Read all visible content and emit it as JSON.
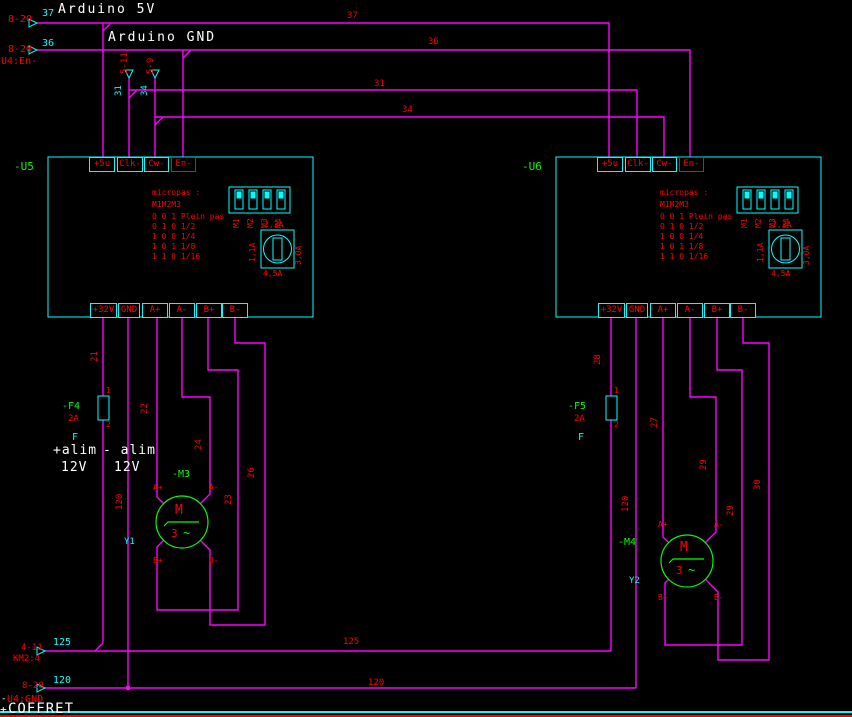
{
  "titles": {
    "arduino_5v": "Arduino 5V",
    "arduino_gnd": "Arduino GND"
  },
  "sources": {
    "s37_ref": "8-20",
    "s37_num": "37",
    "s36_ref": "8-20",
    "s36_dest": "U4:En-",
    "s36_num": "36",
    "x31_ref": "5-11",
    "x31_num": "31",
    "x34_ref": "5-9",
    "x34_num": "34"
  },
  "wire_labels": {
    "w37": "37",
    "w36": "36",
    "w31": "31",
    "w34": "34"
  },
  "drivers": {
    "u5_ref": "-U5",
    "u6_ref": "-U6",
    "top_terms": [
      "+5u",
      "Clk-",
      "Cw-",
      "En-"
    ],
    "bot_terms": [
      "+32V",
      "GND",
      "A+",
      "A-",
      "B+",
      "B-"
    ],
    "micro_title": "micropas :",
    "micro_head": "M1M2M3",
    "micro_rows": [
      "0 0 1 Plein pas",
      "0 1 0 1/2",
      "1 0 0 1/4",
      "1 0 1 1/8",
      "1 1 0 1/16"
    ],
    "dip": [
      "M1",
      "M2",
      "M3",
      "M4"
    ],
    "rotary_top": "2,2A",
    "rotary_left": "1,1A",
    "rotary_right": "3,0A",
    "rotary_bottom": "4,5A"
  },
  "fuses": {
    "f4_ref": "-F4",
    "f5_ref": "-F5",
    "rating": "2A",
    "type": "F",
    "pin1": "1",
    "pin2": "2"
  },
  "supply": {
    "plus": "+alim",
    "minus": "- alim",
    "volt": "12V"
  },
  "motors": {
    "m3_ref": "-M3",
    "m4_ref": "-M4",
    "sym": "M",
    "phase": "3",
    "tilde": "~",
    "a_plus": "A+",
    "a_minus": "A-",
    "b_plus": "B+",
    "b_minus": "B-",
    "y1": "Y1",
    "y2": "Y2"
  },
  "wire_numbers": {
    "n21": "21",
    "n22": "22",
    "n23": "23",
    "n24": "24",
    "n26": "26",
    "n27": "27",
    "n28": "28",
    "n29a": "29",
    "n29b": "29",
    "n30": "30",
    "n120l": "120",
    "n120r": "120"
  },
  "bottom": {
    "a125_ref": "4-11",
    "a125_dev": "KM2:4",
    "a125_num": "125",
    "w125_mid": "125",
    "a120_ref": "8-20",
    "a120_num": "120",
    "w120_mid": "120",
    "gnd_prefix": "-",
    "gnd_name": "U4:GND",
    "loc_prefix": "+",
    "loc_name": "COFFRET"
  },
  "colors": {
    "wire": "#ff00ff",
    "outline": "#00ffff",
    "text": "#ff0000",
    "component": "#00ff00",
    "note": "#ffffff"
  }
}
